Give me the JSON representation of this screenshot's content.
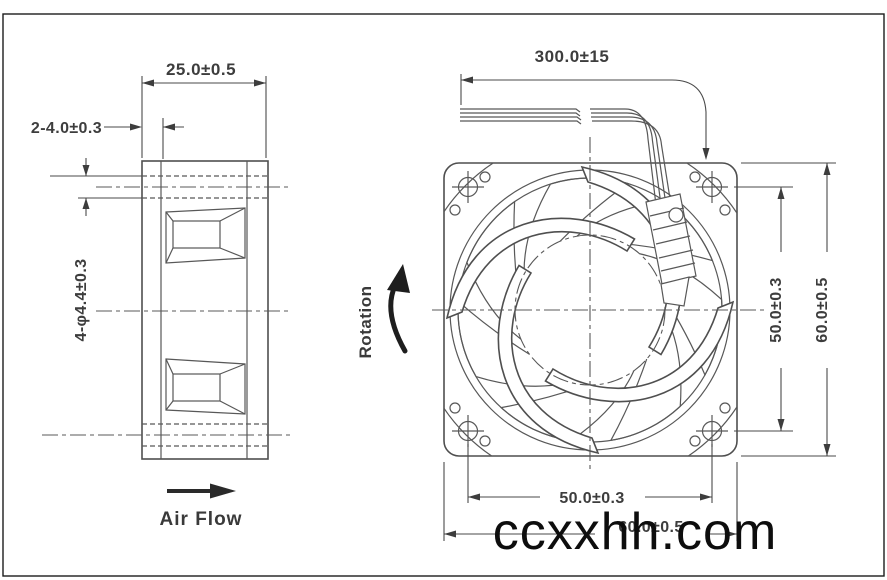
{
  "drawing": {
    "side_view": {
      "width_dim": "25.0±0.5",
      "flange_dim": "2-4.0±0.3",
      "hole_dim": "4-φ4.4±0.3",
      "airflow_label": "Air Flow"
    },
    "front_view": {
      "wire_length_dim": "300.0±15",
      "rotation_label": "Rotation",
      "hole_pitch_vertical_dim": "50.0±0.3",
      "frame_height_dim": "60.0±0.5",
      "hole_pitch_horizontal_dim": "50.0±0.3",
      "frame_width_dim": "60.0±0.5"
    },
    "watermark": "ccxxhh.com",
    "colors": {
      "line": "#4f4f4f",
      "text": "#3d3d3d",
      "watermark": "#0d0d0d",
      "background": "#ffffff"
    }
  }
}
